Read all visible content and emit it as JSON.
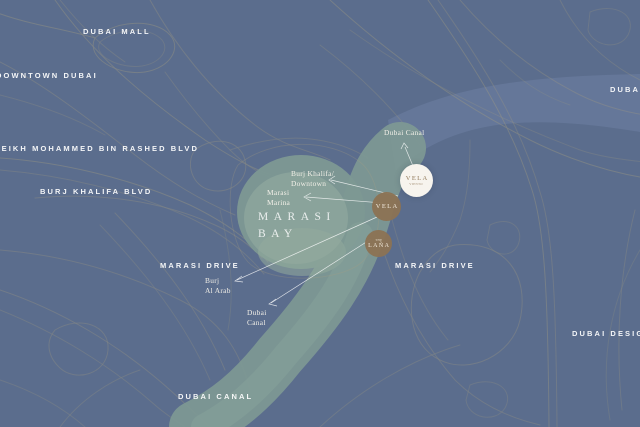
{
  "map": {
    "region_labels": {
      "dubai_mall": "DUBAI MALL",
      "downtown_dubai": "DOWNTOWN DUBAI",
      "sheikh_mohammed_bin_rashed_blvd": "SHEIKH MOHAMMED BIN RASHED BLVD",
      "burj_khalifa_blvd": "BURJ KHALIFA BLVD",
      "marasi_drive_west": "MARASI DRIVE",
      "marasi_drive_east": "MARASI DRIVE",
      "dubai_canal_bottom": "DUBAI CANAL",
      "dubai_right": "DUBAI",
      "dubai_design": "DUBAI DESIGN",
      "marasi_bay_line1": "MARASI",
      "marasi_bay_line2": "BAY"
    },
    "callouts": {
      "dubai_canal_top": "Dubai Canal",
      "burj_khalifa_downtown_line1": "Burj Khalifa/",
      "burj_khalifa_downtown_line2": "Downtown",
      "marasi_marina_line1": "Marasi",
      "marasi_marina_line2": "Marina",
      "burj_al_arab_line1": "Burj",
      "burj_al_arab_line2": "Al Arab",
      "dubai_canal_small_line1": "Dubai",
      "dubai_canal_small_line2": "Canal"
    },
    "markers": {
      "vela_viento": {
        "title": "VELA",
        "subtitle": "VIENTO"
      },
      "vela": {
        "title": "VELA"
      },
      "lana": {
        "pre": "THE",
        "title": "LAÑA"
      }
    },
    "colors": {
      "background": "#5b6d8d",
      "canal_band": "#67799b",
      "canal_water": "#7d9894",
      "bay_water": "#8fa79e",
      "roads": "#a89f80",
      "label_text": "#ffffff",
      "marker_brown": "#8b7254",
      "marker_white_bg": "#f7f4ee",
      "marker_white_text": "#8f7757",
      "callout_line": "#ffffff"
    }
  }
}
